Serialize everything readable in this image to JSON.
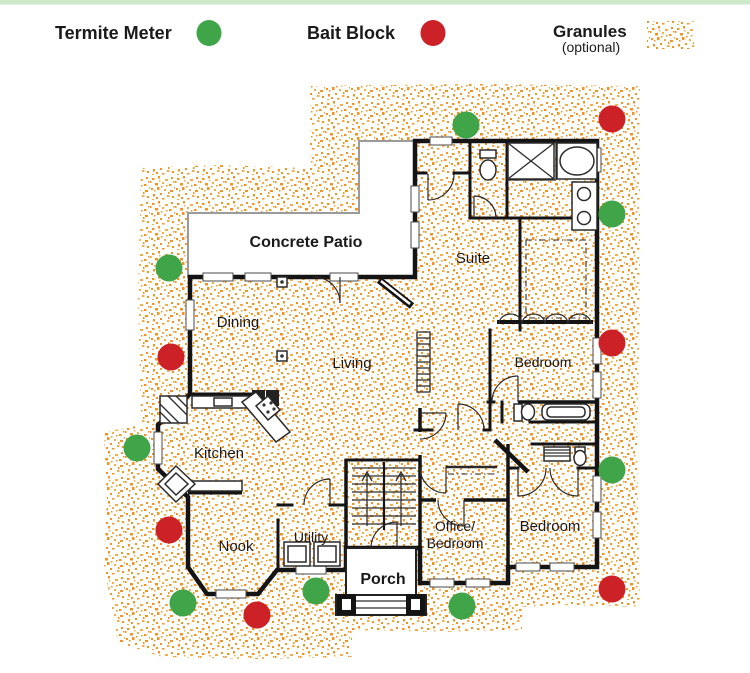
{
  "page": {
    "topbar_color": "#cde8ca",
    "background": "#ffffff"
  },
  "legend": {
    "termite_meter": {
      "label": "Termite Meter",
      "color": "#3fa548"
    },
    "bait_block": {
      "label": "Bait Block",
      "color": "#cb2127"
    },
    "granules": {
      "label": "Granules",
      "sublabel": "(optional)",
      "color": "#f6921e",
      "color2": "#f9ac45"
    }
  },
  "floorplan": {
    "rooms": [
      {
        "id": "concrete-patio",
        "label": "Concrete Patio",
        "x": 306,
        "y": 247,
        "size": 16,
        "bold": true
      },
      {
        "id": "dining",
        "label": "Dining",
        "x": 238,
        "y": 327,
        "size": 15,
        "bold": false
      },
      {
        "id": "living",
        "label": "Living",
        "x": 352,
        "y": 368,
        "size": 15,
        "bold": false
      },
      {
        "id": "suite",
        "label": "Suite",
        "x": 473,
        "y": 263,
        "size": 15,
        "bold": false
      },
      {
        "id": "bedroom-upper",
        "label": "Bedroom",
        "x": 543,
        "y": 367,
        "size": 14,
        "bold": false
      },
      {
        "id": "kitchen",
        "label": "Kitchen",
        "x": 219,
        "y": 458,
        "size": 15,
        "bold": false
      },
      {
        "id": "nook",
        "label": "Nook",
        "x": 236,
        "y": 551,
        "size": 15,
        "bold": false
      },
      {
        "id": "utility",
        "label": "Utility",
        "x": 311,
        "y": 542,
        "size": 14,
        "bold": false
      },
      {
        "id": "porch",
        "label": "Porch",
        "x": 383,
        "y": 584,
        "size": 16,
        "bold": true
      },
      {
        "id": "office-bedroom",
        "label": "Office/",
        "label2": "Bedroom",
        "x": 455,
        "y": 531,
        "size": 14,
        "bold": false
      },
      {
        "id": "bedroom-lower",
        "label": "Bedroom",
        "x": 550,
        "y": 531,
        "size": 15,
        "bold": false
      }
    ],
    "markers": [
      {
        "type": "termite_meter",
        "x": 466,
        "y": 125
      },
      {
        "type": "bait_block",
        "x": 612,
        "y": 119
      },
      {
        "type": "termite_meter",
        "x": 169,
        "y": 268
      },
      {
        "type": "bait_block",
        "x": 171,
        "y": 357
      },
      {
        "type": "termite_meter",
        "x": 612,
        "y": 214
      },
      {
        "type": "bait_block",
        "x": 612,
        "y": 343
      },
      {
        "type": "termite_meter",
        "x": 137,
        "y": 448
      },
      {
        "type": "bait_block",
        "x": 169,
        "y": 530
      },
      {
        "type": "termite_meter",
        "x": 183,
        "y": 603
      },
      {
        "type": "bait_block",
        "x": 257,
        "y": 615
      },
      {
        "type": "termite_meter",
        "x": 316,
        "y": 591
      },
      {
        "type": "termite_meter",
        "x": 462,
        "y": 606
      },
      {
        "type": "termite_meter",
        "x": 612,
        "y": 470
      },
      {
        "type": "bait_block",
        "x": 612,
        "y": 589
      }
    ],
    "marker_radius": 13.5
  }
}
